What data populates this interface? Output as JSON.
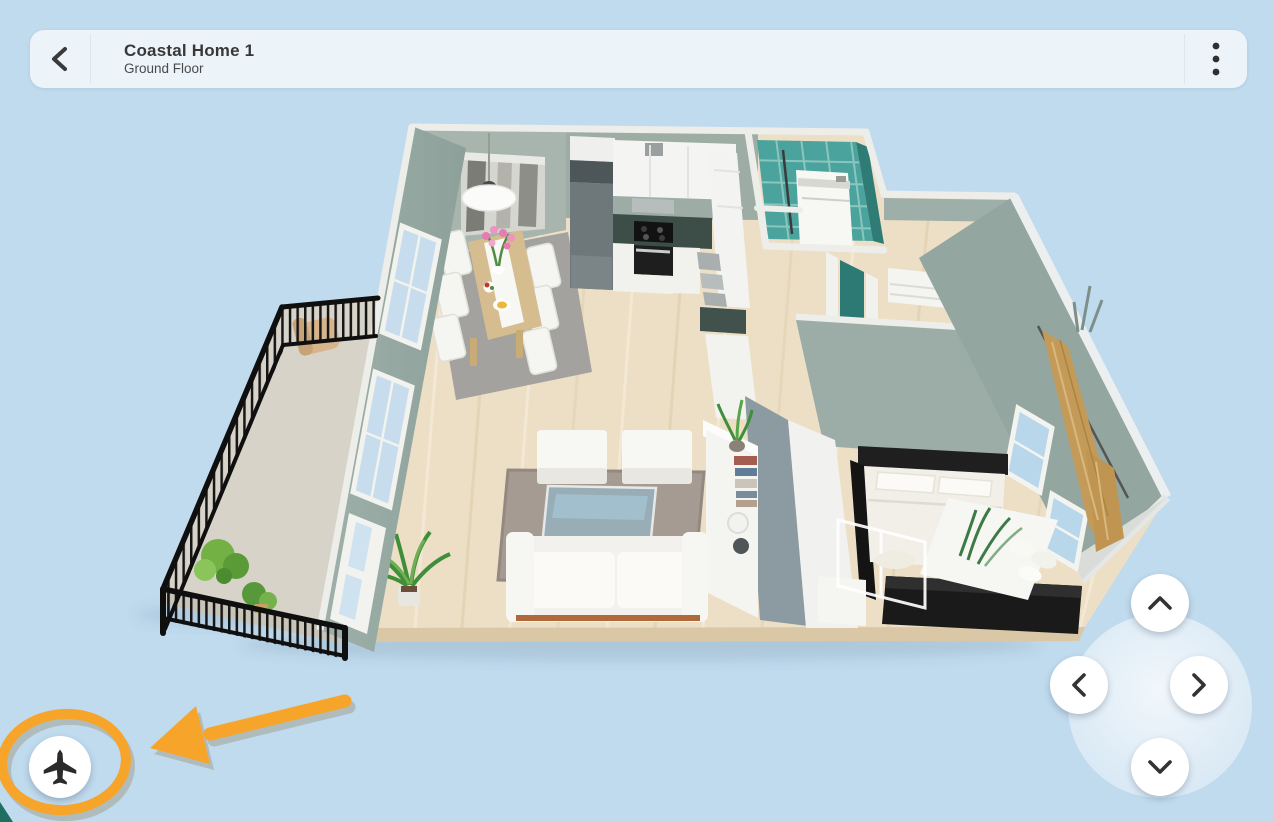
{
  "header": {
    "title": "Coastal Home 1",
    "subtitle": "Ground Floor",
    "back_icon": "chevron-left-icon",
    "menu_icon": "kebab-menu-icon"
  },
  "scene": {
    "view": "3d-dollhouse-floor-plan",
    "rooms": [
      "balcony",
      "living-room",
      "dining-area",
      "kitchen",
      "bathroom",
      "hallway",
      "bedroom"
    ]
  },
  "controls": {
    "fly_mode_button": {
      "icon": "airplane-icon"
    },
    "dpad": {
      "up_icon": "chevron-up-icon",
      "down_icon": "chevron-down-icon",
      "left_icon": "chevron-left-icon",
      "right_icon": "chevron-right-icon"
    }
  },
  "annotation": {
    "type": "highlight",
    "shapes": [
      "ellipse",
      "arrow"
    ],
    "target": "fly-mode-button",
    "color": "#F6A52A"
  },
  "colors": {
    "background": "#C0DAEE",
    "topbar": "#ECF3F9",
    "accent_orange": "#F6A52A",
    "wall_sage": "#A0B0A9",
    "floor_wood": "#ECDFC6",
    "tile_teal": "#4AA39C",
    "curtain_tan": "#C49A58"
  }
}
